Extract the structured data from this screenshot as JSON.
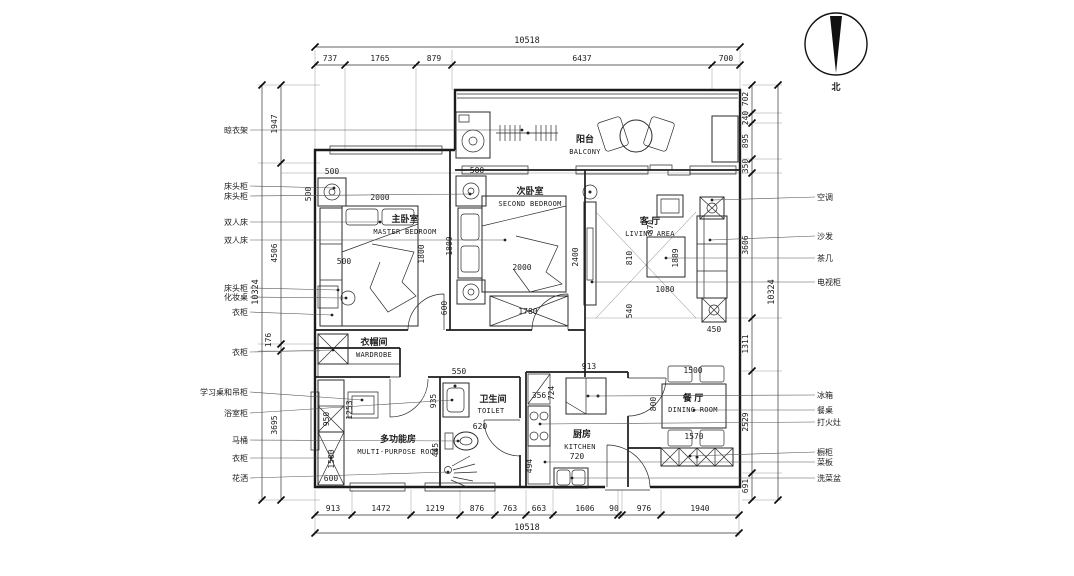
{
  "compass": {
    "label": "北"
  },
  "dims": {
    "top": {
      "total": "10518",
      "segments": [
        "737",
        "1765",
        "879",
        "6437",
        "700"
      ]
    },
    "bottom": {
      "total": "10518",
      "segments": [
        "913",
        "1472",
        "1219",
        "876",
        "763",
        "663",
        "1606",
        "90",
        "976",
        "1940"
      ]
    },
    "left": {
      "total": "10324",
      "segments": [
        "1947",
        "4506",
        "176",
        "3695"
      ]
    },
    "right": {
      "total": "10324",
      "segments": [
        "702",
        "240",
        "895",
        "350",
        "3606",
        "1311",
        "2529",
        "691"
      ]
    }
  },
  "rooms": {
    "balcony": {
      "zh": "阳台",
      "en": "BALCONY"
    },
    "master": {
      "zh": "主卧室",
      "en": "MASTER BEDROOM"
    },
    "second": {
      "zh": "次卧室",
      "en": "SECOND BEDROOM"
    },
    "living": {
      "zh": "客 厅",
      "en": "LIVING AREA"
    },
    "dining": {
      "zh": "餐 厅",
      "en": "DINING ROOM"
    },
    "kitchen": {
      "zh": "厨房",
      "en": "KITCHEN"
    },
    "toilet": {
      "zh": "卫生间",
      "en": "TOILET"
    },
    "multi": {
      "zh": "多功能房",
      "en": "MULTI-PURPOSE ROOM"
    },
    "wardrobe": {
      "zh": "衣帽间",
      "en": "WARDROBE"
    }
  },
  "left_callouts": [
    "晾衣架",
    "床头柜",
    "床头柜",
    "双人床",
    "双人床",
    "床头柜",
    "化妆桌",
    "衣柜",
    "衣柜",
    "学习桌和吊柜",
    "浴室柜",
    "马桶",
    "衣柜",
    "花洒"
  ],
  "right_callouts": [
    "空调",
    "沙发",
    "茶几",
    "电视柜",
    "冰箱",
    "餐桌",
    "打火灶",
    "橱柜",
    "菜板",
    "洗菜盆"
  ],
  "inner_dims": {
    "m500_side": "500",
    "m500_top": "500",
    "m2000": "2000",
    "m1800": "1800",
    "m500_cab": "500",
    "s500_top": "500",
    "s1800": "1800",
    "s2000": "2000",
    "s600": "600",
    "s1780": "1780",
    "tv2400": "2400",
    "l870": "870",
    "l810": "810",
    "l1889": "1889",
    "l1080": "1080",
    "l540": "540",
    "l450": "450",
    "d1500": "1500",
    "d800": "800",
    "d1570": "1570",
    "k913": "913",
    "k724": "724",
    "k356": "356",
    "k720": "720",
    "k494": "494",
    "t550": "550",
    "t935": "935",
    "t620": "620",
    "t445": "445",
    "i1253": "1253",
    "i950": "950",
    "i1500": "1500",
    "i600": "600"
  }
}
